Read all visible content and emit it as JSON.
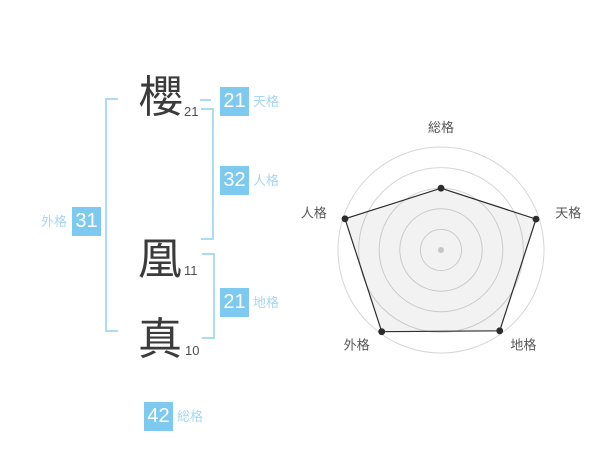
{
  "name_panel": {
    "characters": [
      {
        "char": "櫻",
        "strokes": "21"
      },
      {
        "char": "凰",
        "strokes": "11"
      },
      {
        "char": "真",
        "strokes": "10"
      }
    ],
    "badges": {
      "tenkaku": {
        "value": "21",
        "label": "天格"
      },
      "jinkaku": {
        "value": "32",
        "label": "人格"
      },
      "chikaku": {
        "value": "21",
        "label": "地格"
      },
      "gaikaku": {
        "value": "31",
        "label": "外格"
      },
      "soukaku": {
        "value": "42",
        "label": "総格"
      }
    }
  },
  "colors": {
    "badge_blue": "#7ec9f0",
    "label_blue": "#a6d7f3",
    "bracket_blue": "#abdcf6",
    "kanji_dark": "#3b3b3b",
    "stroke_count_gray": "#4f4f4f",
    "chart_label_gray": "#565656",
    "ring_gray": "#d6d6d6",
    "polygon_line": "#2d2d2d",
    "polygon_fill": "rgba(0,0,0,0.05)",
    "vertex_dot": "#2d2d2d",
    "center_dot_gray": "#c5c5c5"
  },
  "chart_data": {
    "type": "radar",
    "axes": [
      {
        "label": "総格",
        "value": 3.0
      },
      {
        "label": "天格",
        "value": 4.85
      },
      {
        "label": "地格",
        "value": 4.85
      },
      {
        "label": "外格",
        "value": 4.9
      },
      {
        "label": "人格",
        "value": 4.9
      }
    ],
    "max": 5,
    "rings": 5,
    "start_angle_deg": -90,
    "direction": "clockwise",
    "grid_shape": "circles",
    "legend": "none"
  }
}
